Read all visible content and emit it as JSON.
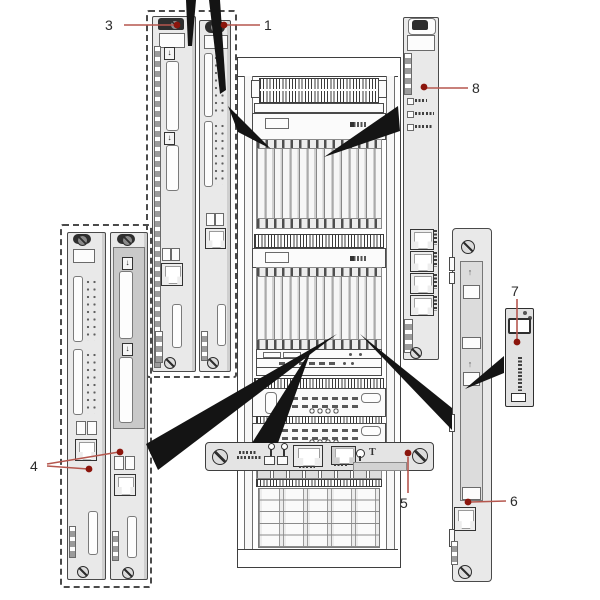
{
  "page": {
    "background": "#ffffff",
    "kind": "hardware-installation-diagram"
  },
  "callouts": [
    {
      "id": "1",
      "label": "1"
    },
    {
      "id": "3",
      "label": "3"
    },
    {
      "id": "4",
      "label": "4"
    },
    {
      "id": "5",
      "label": "5"
    },
    {
      "id": "6",
      "label": "6"
    },
    {
      "id": "7",
      "label": "7"
    },
    {
      "id": "8",
      "label": "8"
    }
  ],
  "symbols": {
    "insert_down_arrow": "↓",
    "insert_up_arrow": "↑"
  },
  "colors": {
    "callout_line": "#b5574e",
    "callout_dot": "#8b150c",
    "diagram_line": "#3c3c3c",
    "arrow_fill": "#141414",
    "board_fill": "#e9e9e9"
  }
}
